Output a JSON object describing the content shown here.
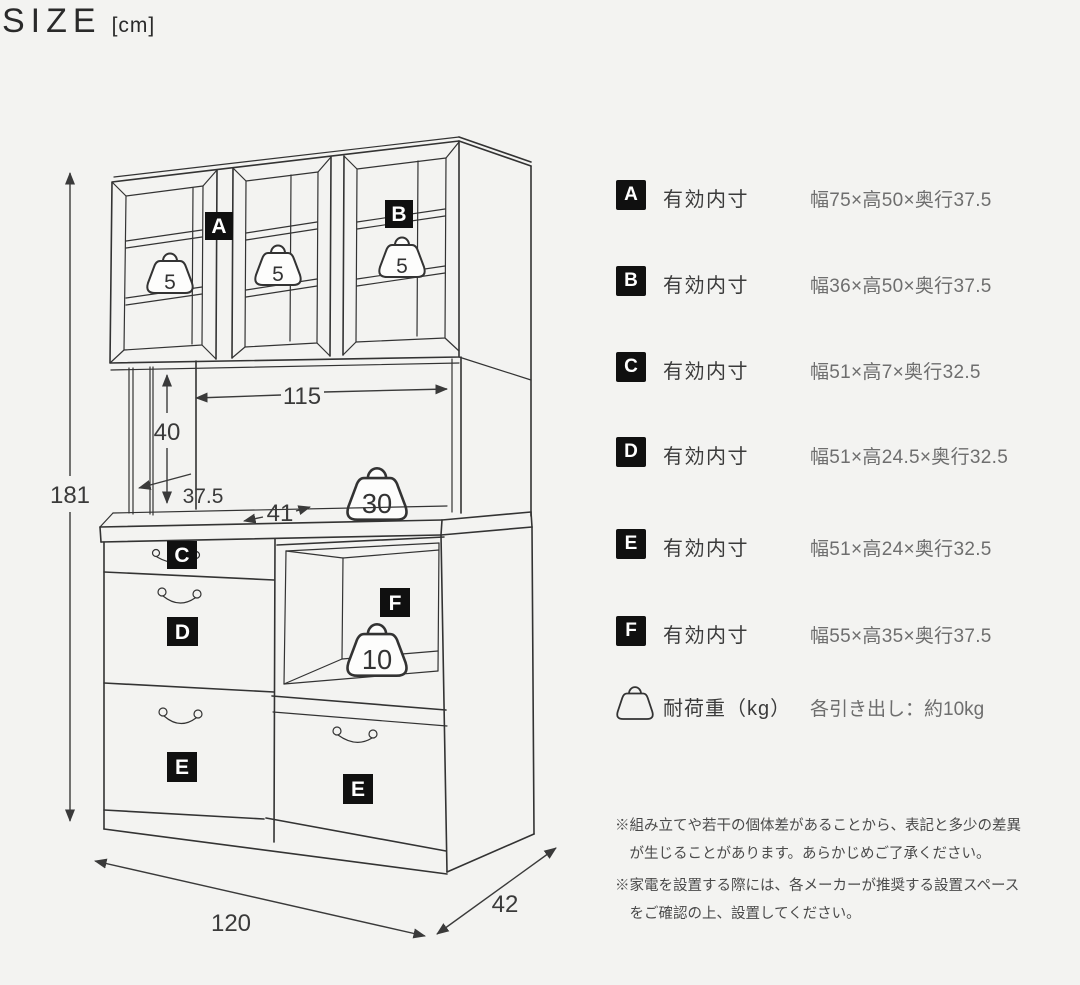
{
  "title": {
    "main": "SIZE",
    "unit": "[cm]"
  },
  "diagram": {
    "dim_height": "181",
    "dim_width": "120",
    "dim_depth": "42",
    "dim_inner_width": "115",
    "dim_open_height": "40",
    "dim_shelf_depth": "37.5",
    "dim_counter_depth": "41",
    "label_a": "A",
    "label_b": "B",
    "label_c": "C",
    "label_d": "D",
    "label_e_left": "E",
    "label_e_right": "E",
    "label_f": "F",
    "weight_shelf1": "5",
    "weight_shelf2": "5",
    "weight_shelf3": "5",
    "weight_counter": "30",
    "weight_niche": "10"
  },
  "legend": {
    "rows": [
      {
        "letter": "A",
        "label": "有効内寸",
        "value": "幅75×高50×奥行37.5"
      },
      {
        "letter": "B",
        "label": "有効内寸",
        "value": "幅36×高50×奥行37.5"
      },
      {
        "letter": "C",
        "label": "有効内寸",
        "value": "幅51×高7×奥行32.5"
      },
      {
        "letter": "D",
        "label": "有効内寸",
        "value": "幅51×高24.5×奥行32.5"
      },
      {
        "letter": "E",
        "label": "有効内寸",
        "value": "幅51×高24×奥行32.5"
      },
      {
        "letter": "F",
        "label": "有効内寸",
        "value": "幅55×高35×奥行37.5"
      }
    ],
    "load": {
      "label": "耐荷重（kg）",
      "value": "各引き出し：約10kg"
    }
  },
  "notes": [
    "※組み立てや若干の個体差があることから、表記と多少の差異が生じることがあります。あらかじめご了承ください。",
    "※家電を設置する際には、各メーカーが推奨する設置スペースをご確認の上、設置してください。"
  ]
}
